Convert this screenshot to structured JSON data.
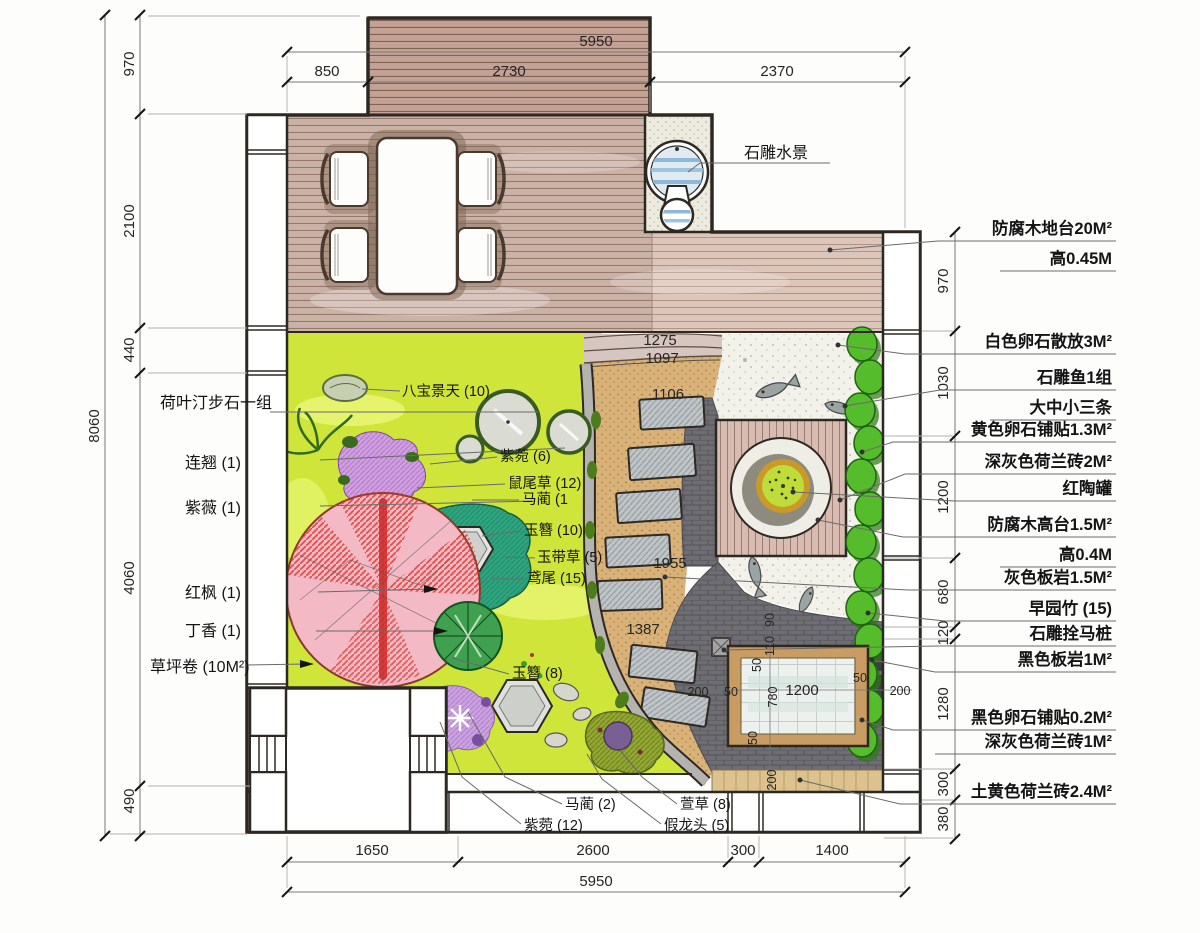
{
  "water_feature_label": "石雕水景",
  "left_labels": [
    "荷叶汀步石一组",
    "连翘 (1)",
    "紫薇 (1)",
    "红枫 (1)",
    "丁香 (1)",
    "草坪卷 (10M²)"
  ],
  "right_annotations": [
    "防腐木地台20M²",
    "高0.45M",
    "白色卵石散放3M²",
    "石雕鱼1组",
    "大中小三条",
    "黄色卵石铺贴1.3M²",
    "深灰色荷兰砖2M²",
    "红陶罐",
    "防腐木高台1.5M²",
    "高0.4M",
    "灰色板岩1.5M²",
    "早园竹 (15)",
    "石雕拴马桩",
    "黑色板岩1M²",
    "黑色卵石铺贴0.2M²",
    "深灰色荷兰砖1M²",
    "土黄色荷兰砖2.4M²"
  ],
  "plant_labels": [
    "八宝景天 (10)",
    "紫菀 (6)",
    "鼠尾草 (12)",
    "马蔺 (1",
    "玉簪 (10)",
    "玉带草 (5)",
    "鸢尾 (15)",
    "玉簪 (8)",
    "马蔺 (2)",
    "紫菀 (12)",
    "萱草 (8)",
    "假龙头 (5)"
  ],
  "dims": {
    "top_total": "5950",
    "top": [
      "850",
      "2730",
      "2370"
    ],
    "left_total": "8060",
    "left": [
      "970",
      "2100",
      "440",
      "4060",
      "490"
    ],
    "right": [
      "970",
      "1030",
      "1200",
      "680",
      "120",
      "1280",
      "300",
      "380"
    ],
    "bottom": [
      "1650",
      "2600",
      "300",
      "1400"
    ],
    "bottom_total": "5950",
    "inner": {
      "a": "1275",
      "b": "1097",
      "c": "1106",
      "d": "1955",
      "e": "1387"
    },
    "pool": {
      "v1": "90",
      "v2": "110",
      "v3": "50",
      "h_left": "200",
      "frame_l": "50",
      "width": "1200",
      "height": "780",
      "frame_r": "50",
      "h_right": "200",
      "frame_b": "50",
      "v_bottom": "200"
    }
  },
  "colors": {
    "lawn": "#cfe53a",
    "deck_wood": "#cbb2a7",
    "deck_light": "#dcc6ba",
    "sand_path": "#d9b27a",
    "dark_brick": "#6e6d72",
    "band_gray": "#b5b3b0",
    "pebble": "#f2f1ea",
    "bamboo": "#55bd2b",
    "maple_red": "#d9352e",
    "maple_pink": "#f3b9c4",
    "shrub_purple": "#cf9fe0",
    "plant_teal": "#2fa57f",
    "pool_frame": "#c89c63",
    "outline": "#2e2823"
  }
}
